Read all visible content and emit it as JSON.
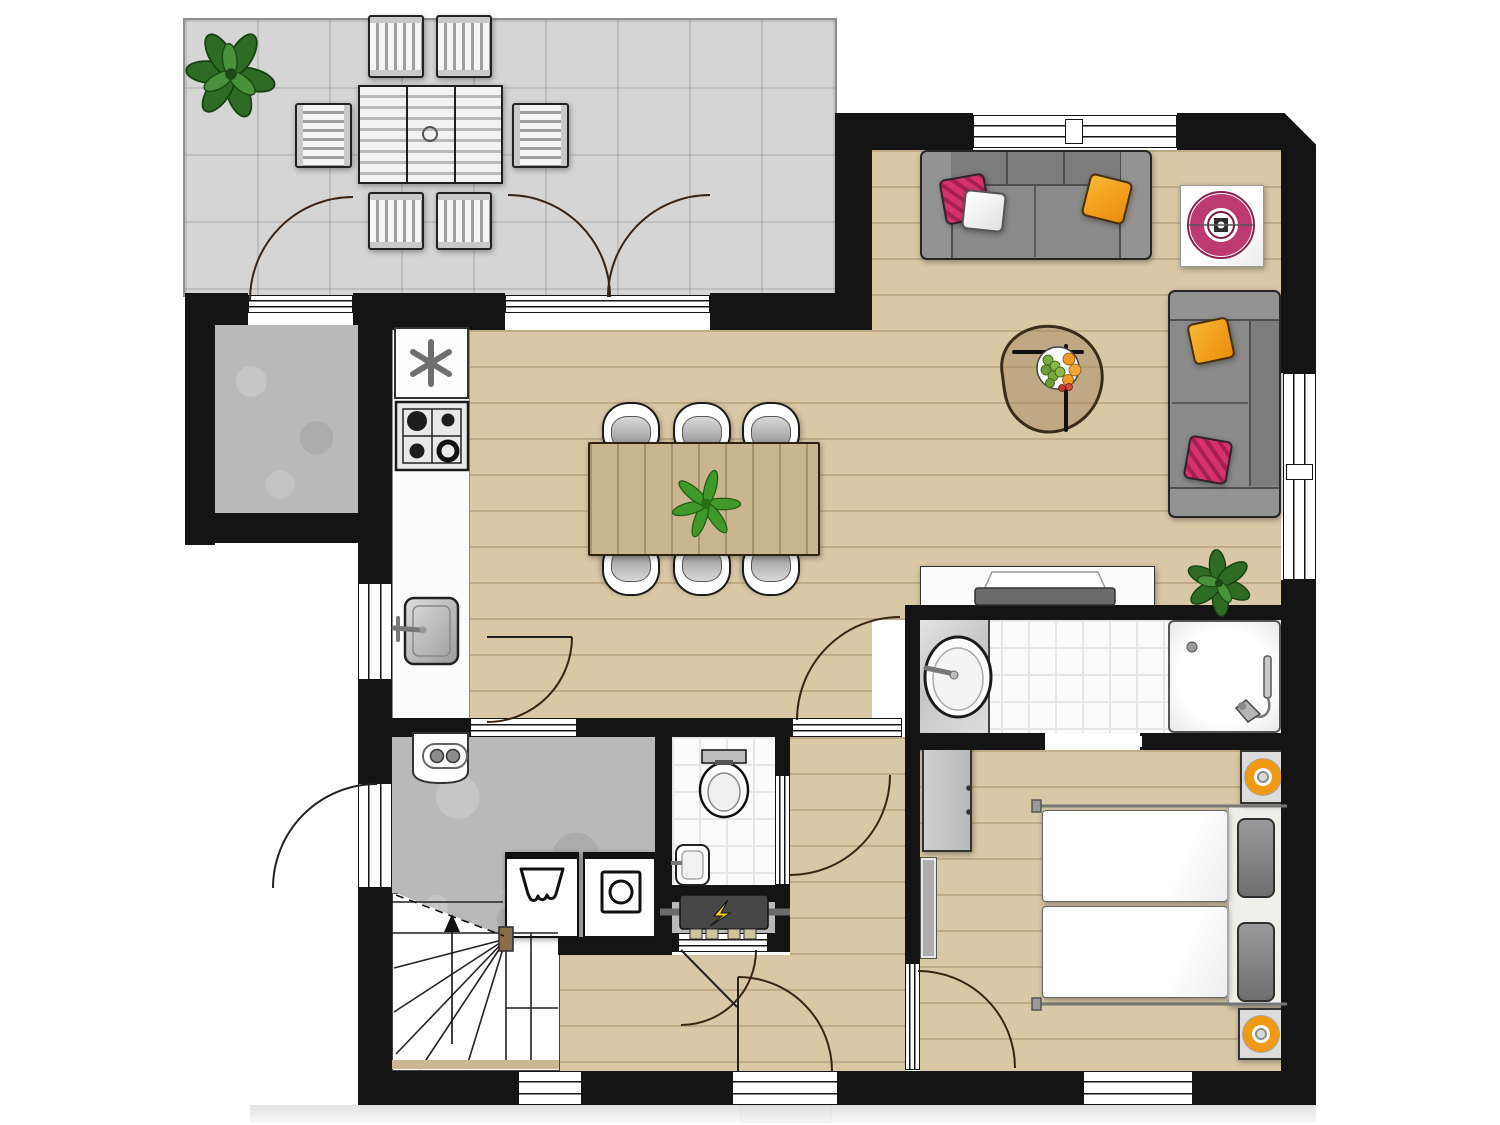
{
  "document": {
    "kind": "architectural-floor-plan",
    "view": "top-down 2D furnished plan",
    "visible_text": "none",
    "background": "#ffffff"
  },
  "palette": {
    "wall": "#141414",
    "wood_floor": "#d9c8a6",
    "terrace_tile": "#d5d5d5",
    "concrete_floor": "#b9b9b9",
    "bath_tile": "#fbfbfb",
    "accent_pink": "#d6336c",
    "accent_orange": "#f09a13",
    "plant_green": "#2e6b24",
    "sofa_gray": "#8a8a8a",
    "table_wood": "#c9b68e"
  },
  "rooms": [
    {
      "name": "terrace",
      "floor": "gray tile grid",
      "contents": [
        "potted-plant",
        "outdoor-table-6-seats",
        "six-slatted-chairs"
      ]
    },
    {
      "name": "storage-room",
      "floor": "concrete",
      "contents": []
    },
    {
      "name": "kitchen-dining",
      "floor": "wood plank",
      "contents": [
        "fridge-freezer",
        "gas-hob-4-burners",
        "kitchen-sink",
        "counter",
        "dining-table",
        "six-chairs",
        "table-plant"
      ]
    },
    {
      "name": "living-room",
      "floor": "wood plank",
      "contents": [
        "sofa-3-seat",
        "sofa-2-seat",
        "coffee-table-with-fruit-bowl",
        "wall-art-pink-ring",
        "tv-lowboard",
        "plant",
        "pillows"
      ]
    },
    {
      "name": "bathroom",
      "floor": "white tile",
      "contents": [
        "washbasin-on-marble-counter",
        "shower-tray-with-hand-shower",
        "sliding-door"
      ]
    },
    {
      "name": "wc",
      "floor": "white tile",
      "contents": [
        "toilet",
        "small-hand-basin"
      ]
    },
    {
      "name": "technical-room",
      "floor": "concrete",
      "contents": [
        "power-socket-box",
        "washing-machine",
        "dryer",
        "electrical-panel"
      ]
    },
    {
      "name": "hall",
      "floor": "wood plank",
      "contents": [
        "front-door"
      ]
    },
    {
      "name": "stairwell",
      "floor": "white",
      "contents": [
        "winder-staircase",
        "up-arrow",
        "dashed-headroom-line"
      ]
    },
    {
      "name": "bedroom",
      "floor": "wood plank",
      "contents": [
        "double-bed-two-mattresses",
        "two-nightstands-with-orange-lamps",
        "wardrobe",
        "tall-mirror",
        "gray-pillows"
      ]
    }
  ],
  "openings": {
    "windows": 6,
    "exterior_doors": 4,
    "interior_doors": 6,
    "sliding_doors": 1,
    "double_terrace_door": 1
  }
}
